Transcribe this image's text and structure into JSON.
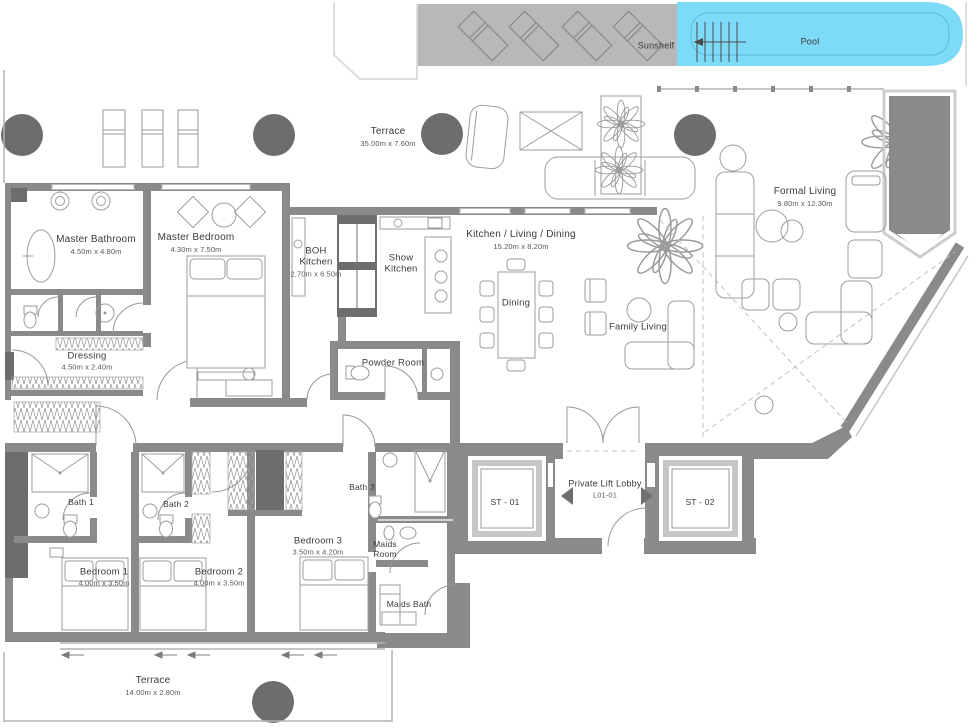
{
  "title": "Apartment Floor Plan L01-01",
  "colors": {
    "pool": "#7edbf7",
    "pool_line": "#54bede",
    "sunshelf": "#b8b8b8",
    "wall": "#8a8a8a",
    "column": "#6d6d6d",
    "text": "#3a3a3a"
  },
  "rooms": [
    {
      "id": "sunshelf",
      "lines": [
        "Sunshelf"
      ],
      "x": 656,
      "y": 46,
      "fs": 9
    },
    {
      "id": "pool",
      "lines": [
        "Pool"
      ],
      "x": 810,
      "y": 42,
      "fs": 9
    },
    {
      "id": "terrace-top",
      "lines": [
        "Terrace"
      ],
      "dims": "35.00m x 7.60m",
      "x": 388,
      "y": 137,
      "fs": 10
    },
    {
      "id": "master-bathroom",
      "lines": [
        "Master Bathroom"
      ],
      "dims": "4.50m x 4.80m",
      "x": 96,
      "y": 245,
      "fs": 10
    },
    {
      "id": "master-bedroom",
      "lines": [
        "Master Bedroom"
      ],
      "dims": "4.30m x 7.50m",
      "x": 196,
      "y": 243,
      "fs": 10
    },
    {
      "id": "boh-kitchen",
      "lines": [
        "BOH",
        "Kitchen"
      ],
      "dims": "2.70m x 6.50m",
      "x": 316,
      "y": 262,
      "fs": 9.5
    },
    {
      "id": "show-kitchen",
      "lines": [
        "Show",
        "Kitchen"
      ],
      "x": 401,
      "y": 264,
      "fs": 9.5
    },
    {
      "id": "kitchen-living-dining",
      "lines": [
        "Kitchen / Living / Dining"
      ],
      "dims": "15.20m x 8.20m",
      "x": 521,
      "y": 240,
      "fs": 10
    },
    {
      "id": "dining",
      "lines": [
        "Dining"
      ],
      "x": 516,
      "y": 303,
      "fs": 9.5
    },
    {
      "id": "formal-living",
      "lines": [
        "Formal Living"
      ],
      "dims": "9.80m x 12.30m",
      "x": 805,
      "y": 197,
      "fs": 10
    },
    {
      "id": "family-living",
      "lines": [
        "Family Living"
      ],
      "x": 638,
      "y": 327,
      "fs": 9.5
    },
    {
      "id": "dressing",
      "lines": [
        "Dressing"
      ],
      "dims": "4.50m x 2.40m",
      "x": 87,
      "y": 361,
      "fs": 9.5
    },
    {
      "id": "powder-room",
      "lines": [
        "Powder Room"
      ],
      "x": 393,
      "y": 363,
      "fs": 9.5
    },
    {
      "id": "bath-1",
      "lines": [
        "Bath 1"
      ],
      "x": 81,
      "y": 502,
      "fs": 8.5
    },
    {
      "id": "bath-2",
      "lines": [
        "Bath 2"
      ],
      "x": 176,
      "y": 504,
      "fs": 8.5
    },
    {
      "id": "bath-3",
      "lines": [
        "Bath 3"
      ],
      "x": 362,
      "y": 487,
      "fs": 8.5
    },
    {
      "id": "bedroom-1",
      "lines": [
        "Bedroom 1"
      ],
      "dims": "4.00m x 3.50m",
      "x": 104,
      "y": 577,
      "fs": 9.5
    },
    {
      "id": "bedroom-2",
      "lines": [
        "Bedroom 2"
      ],
      "dims": "4.00m x 3.50m",
      "x": 219,
      "y": 577,
      "fs": 9.5
    },
    {
      "id": "bedroom-3",
      "lines": [
        "Bedroom 3"
      ],
      "dims": "3.50m x 4.20m",
      "x": 318,
      "y": 546,
      "fs": 9.5
    },
    {
      "id": "maids-room",
      "lines": [
        "Maids",
        "Room"
      ],
      "x": 385,
      "y": 549,
      "fs": 8.5
    },
    {
      "id": "maids-bath",
      "lines": [
        "Maids Bath"
      ],
      "x": 409,
      "y": 604,
      "fs": 8.5
    },
    {
      "id": "private-lift-lobby",
      "lines": [
        "Private Lift Lobby"
      ],
      "dims": "L01-01",
      "x": 605,
      "y": 489,
      "fs": 9
    },
    {
      "id": "st-01",
      "lines": [
        "ST - 01"
      ],
      "x": 505,
      "y": 502,
      "fs": 8.5
    },
    {
      "id": "st-02",
      "lines": [
        "ST - 02"
      ],
      "x": 700,
      "y": 502,
      "fs": 8.5
    },
    {
      "id": "terrace-bottom",
      "lines": [
        "Terrace"
      ],
      "dims": "14.00m x 2.80m",
      "x": 153,
      "y": 686,
      "fs": 10
    }
  ]
}
